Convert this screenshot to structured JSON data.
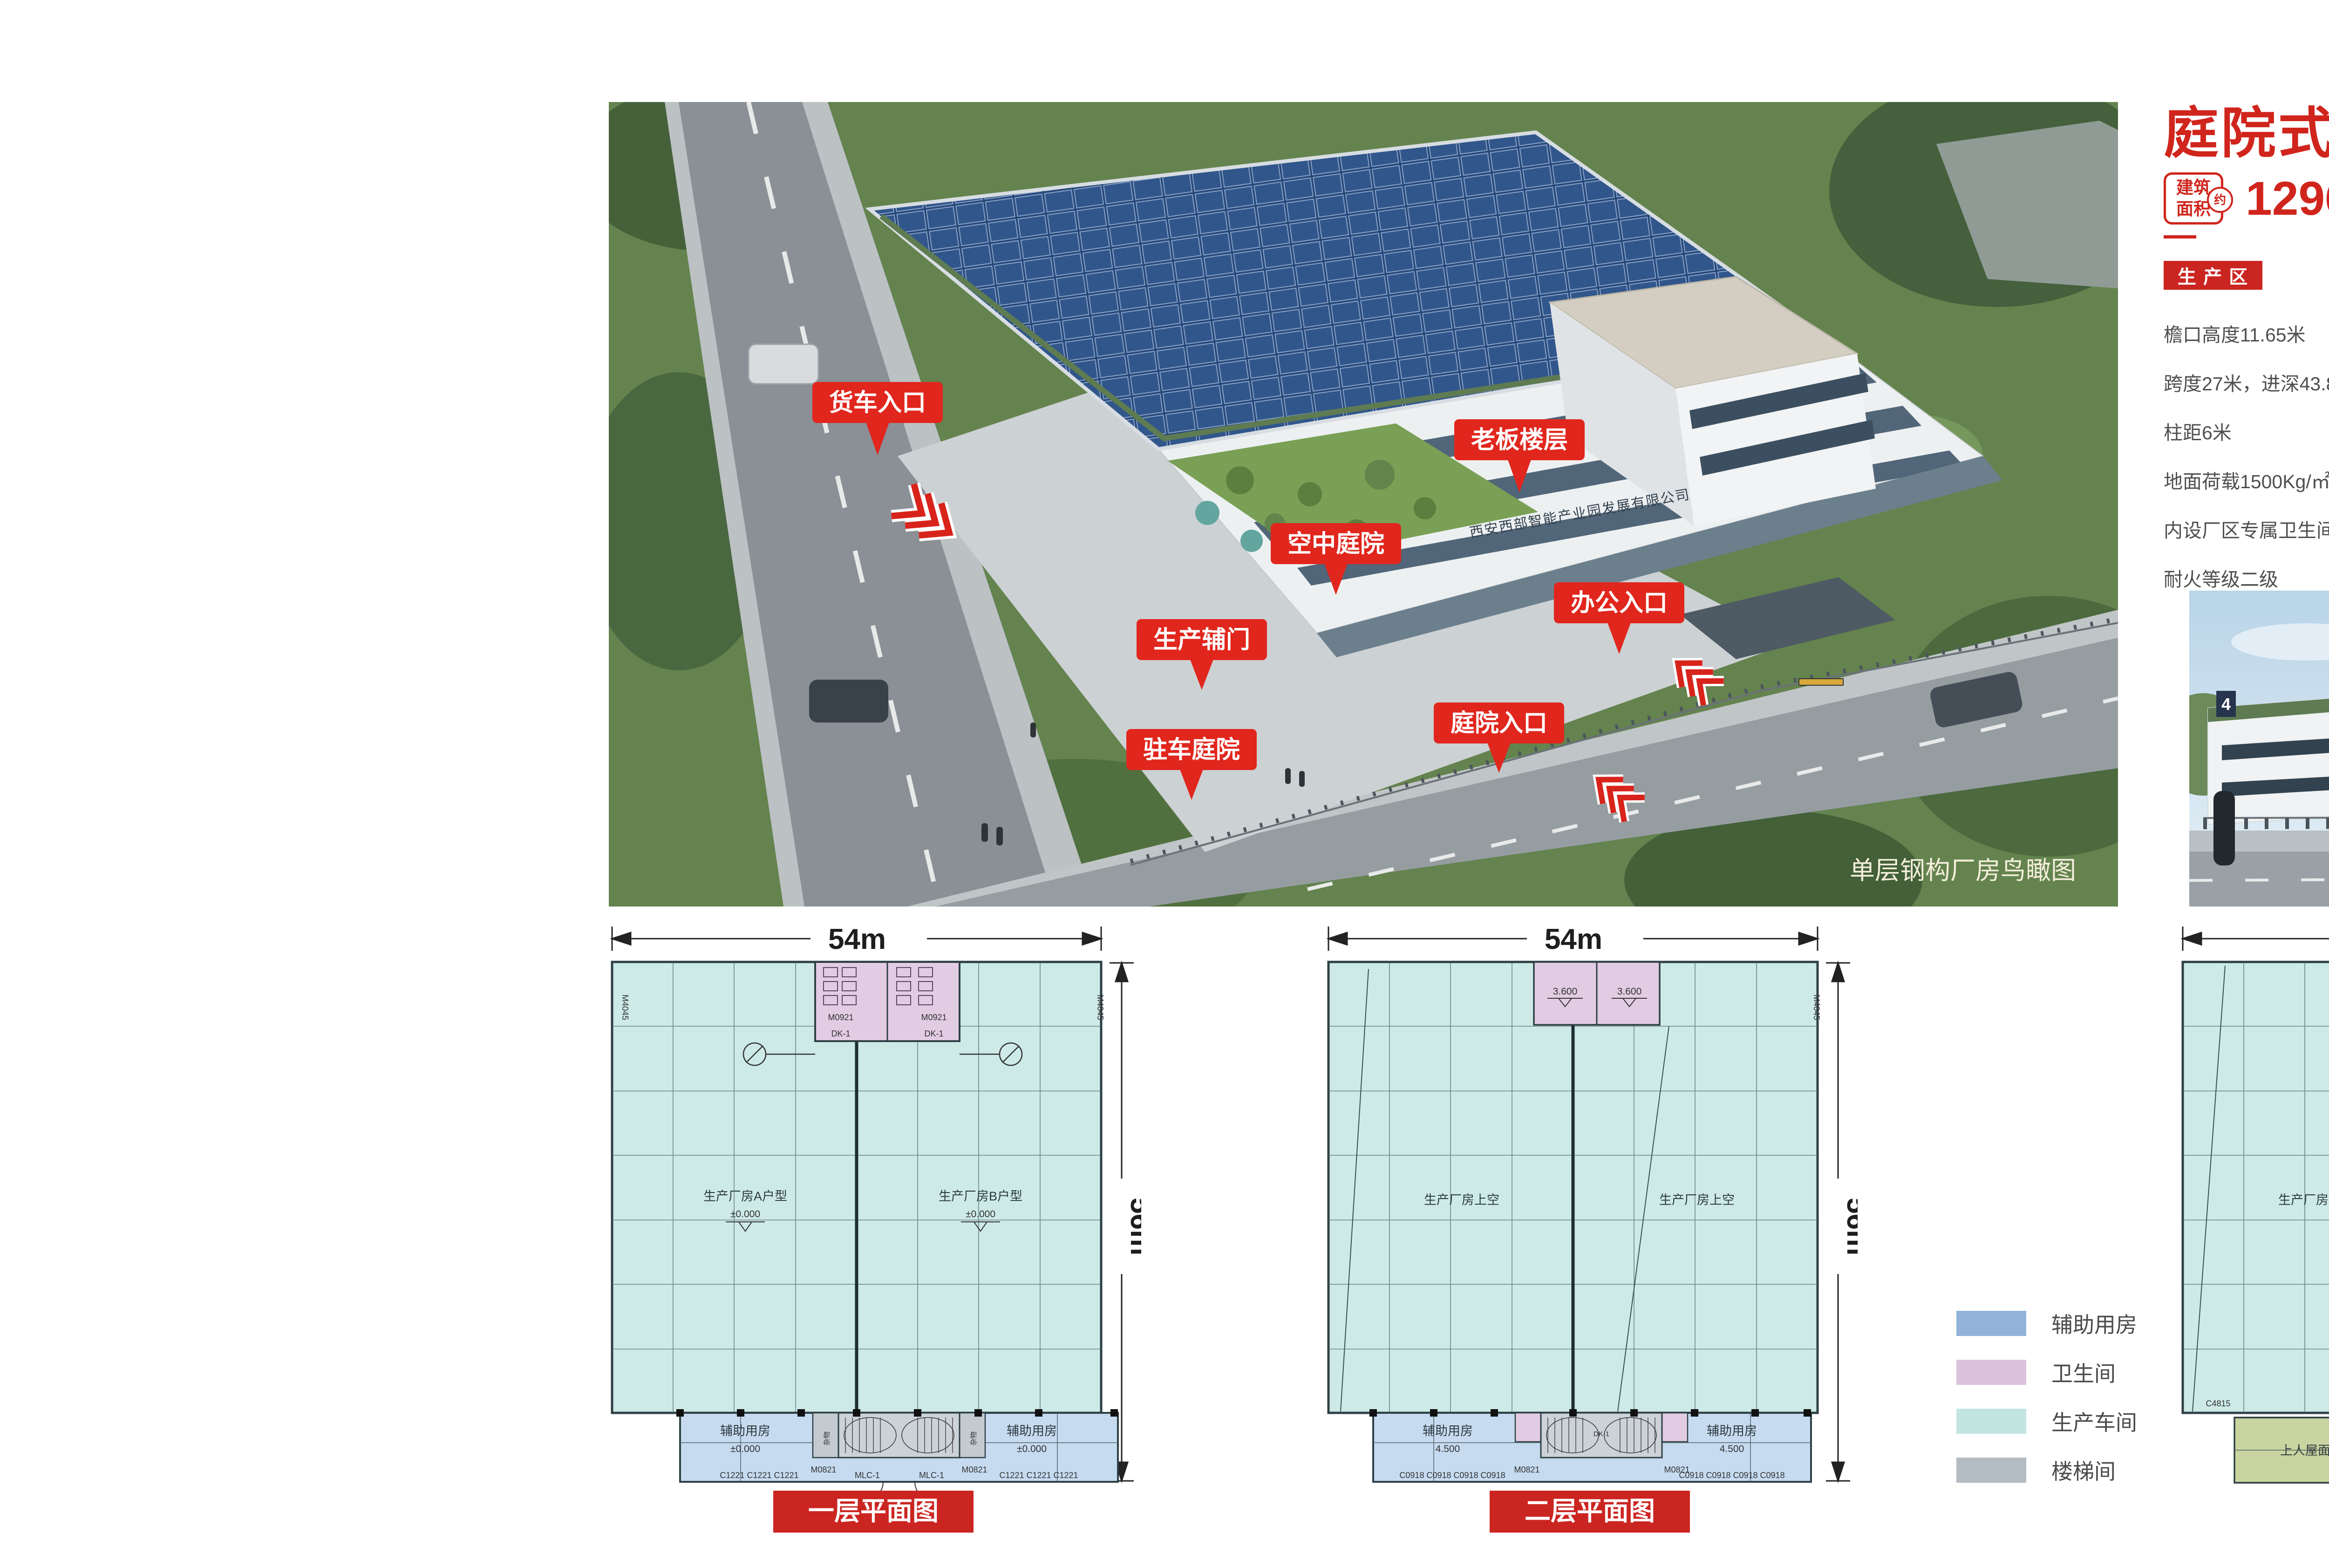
{
  "colors": {
    "accent_red": "#d0251c",
    "callout_red": "#e1261d",
    "badge_red": "#cb2521",
    "spec_text": "#4f4f4f",
    "workshop_fill": "#cdeae7",
    "aux_fill": "#c6dbf0",
    "wc_fill": "#e2cce3",
    "stair_fill": "#c3cbd1",
    "roof_fill": "#c9d4a0",
    "solar_blue": "#2c5183",
    "facade_green": "#5e7b52"
  },
  "header": {
    "title": "庭院式双拼单层钢构",
    "area_badge": {
      "line1": "建筑",
      "line2": "面积",
      "approx": "约"
    },
    "area_value": "1296m²+405m²",
    "area_note": "（以4号厂房为例）"
  },
  "specs": {
    "production": {
      "title": "生 产 区",
      "items": [
        "檐口高度11.65米",
        "跨度27米，进深43.8米",
        "柱距6米",
        "地面荷载1500Kg/㎡",
        "内设厂区专属卫生间",
        "耐火等级二级"
      ]
    },
    "office": {
      "title": "办 公 区",
      "items": [
        "辅房高度13.05米",
        "首层层高4.5米",
        "二、三层层高3.9米",
        "赠送空中庭院104㎡",
        "标准承重400Kg/㎡",
        "赠送私属驻车庭院495㎡"
      ]
    }
  },
  "aerial": {
    "caption": "单层钢构厂房鸟瞰图",
    "building_sign": "西安西部智能产业园发展有限公司",
    "callouts": {
      "truck": "货车入口",
      "boss": "老板楼层",
      "sky_garden": "空中庭院",
      "office_entry": "办公入口",
      "side_door": "生产辅门",
      "courtyard_entry": "庭院入口",
      "parking": "驻车庭院"
    }
  },
  "render": {
    "caption": "单层钢构厂房效果图",
    "unit_plate": "4"
  },
  "legend": {
    "items": [
      {
        "label": "辅助用房",
        "color": "#92b2d8"
      },
      {
        "label": "卫生间",
        "color": "#dcc3dd"
      },
      {
        "label": "生产车间",
        "color": "#c3e5e2"
      },
      {
        "label": "楼梯间",
        "color": "#b3bcc3"
      }
    ]
  },
  "plans": [
    {
      "title": "一层平面图",
      "dim_w": "54m",
      "dim_h": "56m",
      "room_left": "生产厂房A户型",
      "room_right": "生产厂房B户型",
      "level_left": "±0.000",
      "level_right": "±0.000",
      "wc_door": "M0921",
      "stair_code": "DK-1",
      "aux_left": "辅助用房",
      "aux_left_level": "±0.000",
      "aux_right": "辅助用房",
      "aux_right_level": "±0.000",
      "misc_left": "杂物",
      "misc_right": "杂物",
      "door_left": "M0821",
      "door_right": "M0821",
      "entry_left": "MLC-1",
      "entry_right": "MLC-1",
      "win_left": "C1221 C1221 C1221",
      "win_right": "C1221 C1221 C1221",
      "side_door": "M4045"
    },
    {
      "title": "二层平面图",
      "dim_w": "54m",
      "dim_h": "56m",
      "room_left": "生产厂房上空",
      "room_right": "生产厂房上空",
      "wc_level_left": "3.600",
      "wc_level_right": "3.600",
      "aux_left": "辅助用房",
      "aux_left_level": "4.500",
      "aux_right": "辅助用房",
      "aux_right_level": "4.500",
      "door_left": "M0821",
      "door_right": "M0821",
      "stair_code": "DK-1",
      "win_left": "C0918 C0918 C0918 C0918",
      "win_right": "C0918 C0918 C0918 C0918",
      "side_door": "M4045"
    },
    {
      "title": "三层平面图",
      "dim_w": "54m",
      "dim_h": "56m",
      "room_left": "生产厂房上空",
      "room_right": "生产厂房上空",
      "roof_left": "上人屋面",
      "roof_right": "上人屋面",
      "aux_left": "辅助用房",
      "aux_left_level": "8.400",
      "aux_right": "辅助用房",
      "aux_right_level": "8.400",
      "door_left": "M0821",
      "door_right": "M0821",
      "stair_code": "DK-1",
      "corner_left": "C4815",
      "corner_right": "C4815",
      "win_center": "C0918 C0918 C0918 C0918",
      "side_door": "M4045"
    }
  ]
}
